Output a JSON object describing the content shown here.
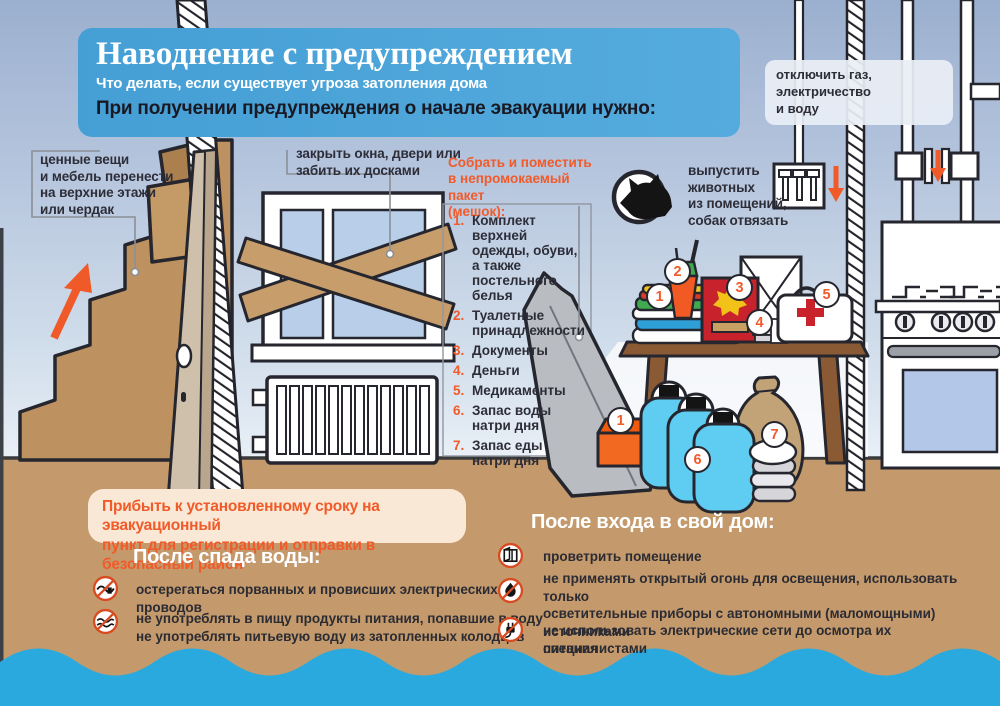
{
  "colors": {
    "accent": "#f15a29",
    "header_blue": "#4aa4d7",
    "water": "#29a9dd",
    "floor": "#c49a6c"
  },
  "header": {
    "title": "Наводнение с предупреждением",
    "subtitle": "Что делать, если существует угроза затопления дома",
    "instruction": "При получении предупреждения о начале эвакуации нужно:"
  },
  "callouts": {
    "valuables": "ценные вещи\nи мебель перенести\nна верхние этажи\nили чердак",
    "windows": "закрыть окна, двери или\nзабить их досками",
    "utilities": "отключить газ, электричество\nи воду",
    "animals": "выпустить\nживотных\nиз помещений,\nсобак отвязать"
  },
  "pack": {
    "title": "Собрать и поместить\nв непромокаемый пакет\n(мешок):",
    "items": [
      {
        "num": "1.",
        "text": "Комплект верхней\nодежды, обуви,\nа также постельного\nбелья"
      },
      {
        "num": "2.",
        "text": "Туалетные\nпринадлежности"
      },
      {
        "num": "3.",
        "text": "Документы"
      },
      {
        "num": "4.",
        "text": "Деньги"
      },
      {
        "num": "5.",
        "text": "Медикаменты"
      },
      {
        "num": "6.",
        "text": "Запас воды\nнатри дня"
      },
      {
        "num": "7.",
        "text": "Запас еды\nнатри дня"
      }
    ]
  },
  "notice": "Прибыть к установленному сроку на эвакуационный\nпункт для регистрации и отправки в безопасный район",
  "after_water": {
    "heading": "После спада воды:",
    "items": [
      {
        "text": "остерегаться порванных и провисших электрических проводов"
      },
      {
        "text": "не употреблять в пищу продукты питания, попавшие в воду\nне употреблять питьевую воду из затопленных колодцев"
      }
    ]
  },
  "after_home": {
    "heading": "После входа в свой дом:",
    "items": [
      {
        "text": "проветрить помещение"
      },
      {
        "text": "не применять открытый огонь для освещения, использовать только\nосветительные приборы с автономными (маломощными) источниками\nпитания"
      },
      {
        "text": "не использовать электрические сети до осмотра их специалистами"
      }
    ]
  },
  "badges": {
    "clothes": "1",
    "toiletries": "2",
    "documents": "3",
    "money": "4",
    "medicine": "5",
    "box": "1",
    "water": "6",
    "food": "7"
  }
}
